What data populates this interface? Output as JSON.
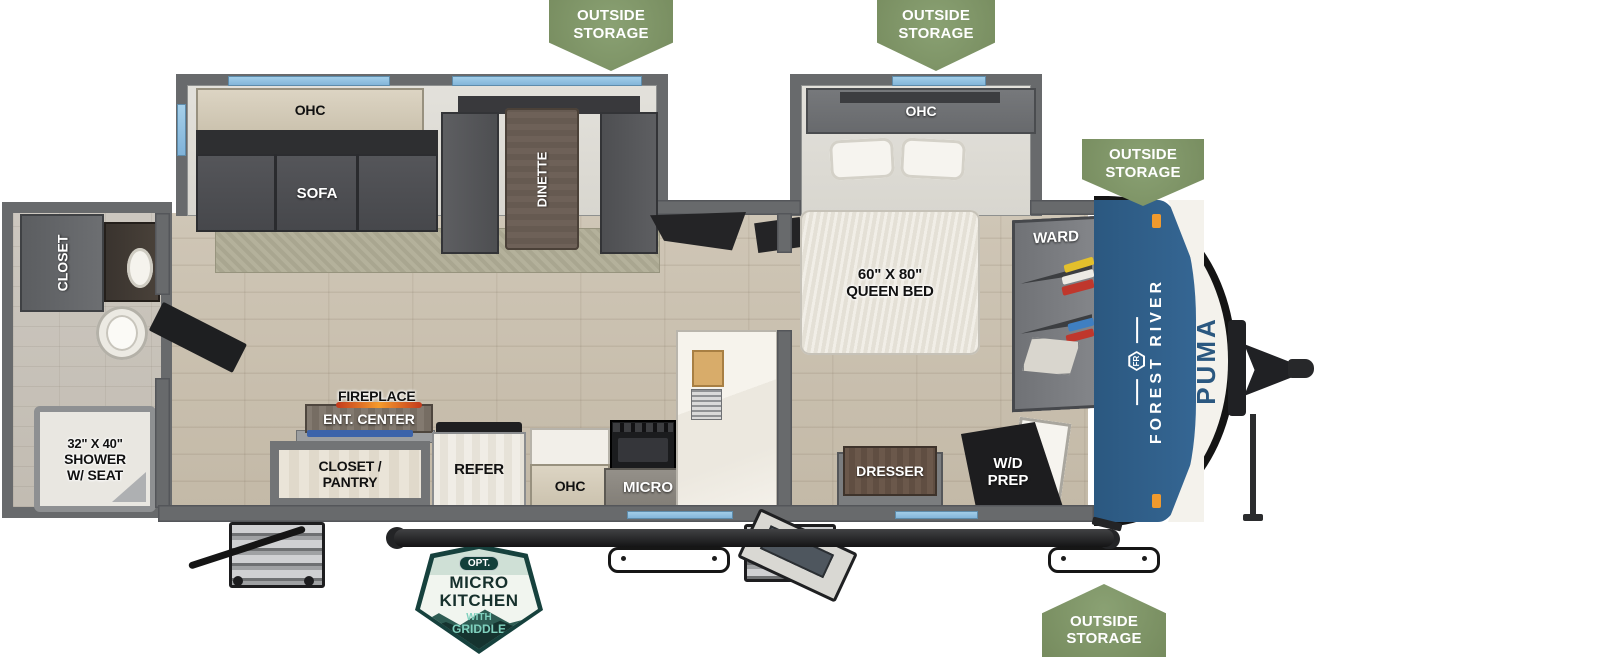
{
  "outside_storage": {
    "line1": "OUTSIDE",
    "line2": "STORAGE"
  },
  "living": {
    "ohc": "OHC",
    "sofa": "SOFA",
    "dinette": "DINETTE"
  },
  "kitchen": {
    "fireplace": "FIREPLACE",
    "ent_center": "ENT. CENTER",
    "closet_pantry_line1": "CLOSET /",
    "closet_pantry_line2": "PANTRY",
    "refer": "REFER",
    "ohc": "OHC",
    "micro": "MICRO"
  },
  "bathroom": {
    "closet": "CLOSET",
    "shower_line1": "32\" X 40\"",
    "shower_line2": "SHOWER",
    "shower_line3": "W/ SEAT"
  },
  "bedroom": {
    "ohc": "OHC",
    "bed_line1": "60\" X 80\"",
    "bed_line2": "QUEEN BED",
    "ward": "WARD",
    "dresser": "DRESSER",
    "wd_line1": "W/D",
    "wd_line2": "PREP"
  },
  "brand": {
    "logo": "FR",
    "name": "FOREST RIVER",
    "model": "PUMA"
  },
  "option_badge": {
    "opt": "OPT.",
    "line1": "MICRO",
    "line2": "KITCHEN",
    "line3": "WITH",
    "line4": "GRIDDLE"
  },
  "colors": {
    "badge_green": "#7E9166",
    "brand_blue": "#2F5E88",
    "window_blue": "#8FC0E2",
    "badge_teal": "#1C564F",
    "flame_orange": "#E8692A"
  }
}
